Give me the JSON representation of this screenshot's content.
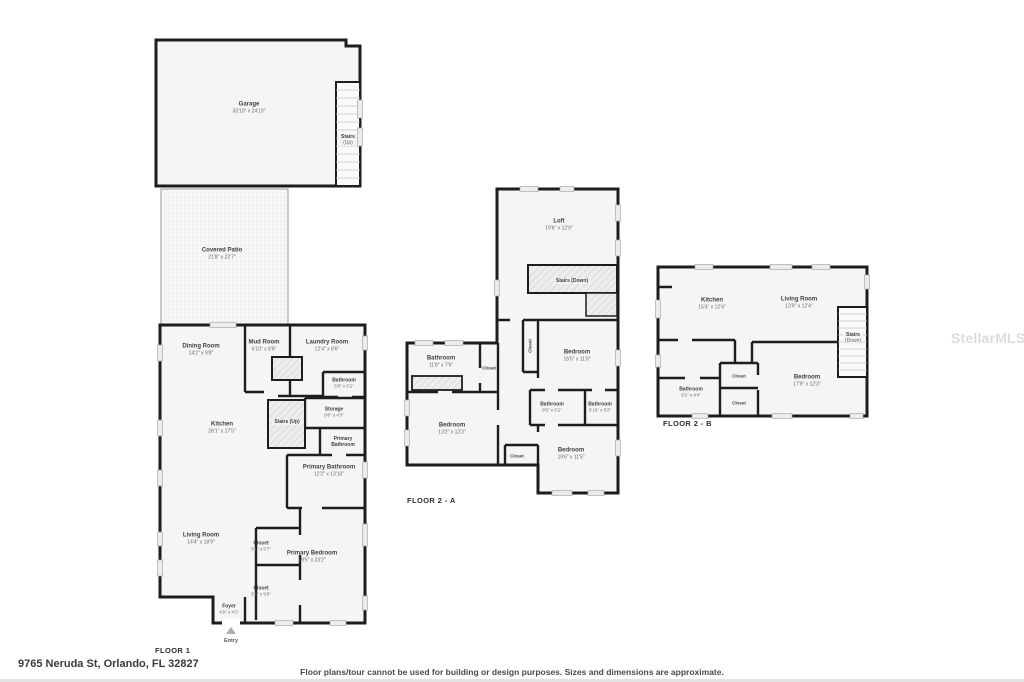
{
  "watermark": "StellarMLS",
  "footer": {
    "address": "9765 Neruda St, Orlando, FL 32827",
    "disclaimer": "Floor plans/tour cannot be used for building or design purposes. Sizes and dimensions are approximate."
  },
  "floor1": {
    "label": "FLOOR 1",
    "entry_label": "Entry",
    "rooms": {
      "garage": {
        "name": "Garage",
        "dims": "33'10\" x 24'10\""
      },
      "garage_stairs": {
        "name": "Stairs",
        "dims": "(Up)"
      },
      "covered_patio": {
        "name": "Covered Patio",
        "dims": "21'8\" x 22'7\""
      },
      "dining_room": {
        "name": "Dining Room",
        "dims": "14'2\" x 9'8\""
      },
      "mud_room": {
        "name": "Mud Room",
        "dims": "6'10\" x 8'6\""
      },
      "laundry_room": {
        "name": "Laundry Room",
        "dims": "12'4\" x 8'6\""
      },
      "bathroom": {
        "name": "Bathroom",
        "dims": "5'8\" x 5'2\""
      },
      "kitchen": {
        "name": "Kitchen",
        "dims": "26'1\" x 17'5\""
      },
      "stairs_up": {
        "name": "Stairs (Up)"
      },
      "storage": {
        "name": "Storage",
        "dims": "9'8\" x 4'3\""
      },
      "primary_bathroom_wc": {
        "name": "Primary Bathroom"
      },
      "primary_bathroom": {
        "name": "Primary Bathroom",
        "dims": "12'2\" x 13'10\""
      },
      "living_room": {
        "name": "Living Room",
        "dims": "14'4\" x 18'9\""
      },
      "closet_1": {
        "name": "Closet",
        "dims": "5'1\" x 5'7\""
      },
      "closet_2": {
        "name": "Closet",
        "dims": "5'1\" x 9'6\""
      },
      "primary_bedroom": {
        "name": "Primary Bedroom",
        "dims": "19'5\" x 23'2\""
      },
      "foyer": {
        "name": "Foyer",
        "dims": "4'9\" x 4'1\""
      }
    }
  },
  "floor2a": {
    "label": "FLOOR 2 - A",
    "rooms": {
      "loft": {
        "name": "Loft",
        "dims": "19'6\" x 12'9\""
      },
      "stairs_down": {
        "name": "Stairs (Down)"
      },
      "closet_hall": {
        "name": "Closet"
      },
      "bedroom_1": {
        "name": "Bedroom",
        "dims": "15'5\" x 11'8\""
      },
      "bathroom_1": {
        "name": "Bathroom",
        "dims": "11'8\" x 7'6\""
      },
      "closet_bath": {
        "name": "Closet"
      },
      "bedroom_2": {
        "name": "Bedroom",
        "dims": "13'2\" x 12'3\""
      },
      "bathroom_2": {
        "name": "Bathroom",
        "dims": "9'5\" x 5'2\""
      },
      "bathroom_3": {
        "name": "Bathroom",
        "dims": "5'10\" x 5'2\""
      },
      "closet_bottom": {
        "name": "Closet"
      },
      "bedroom_3": {
        "name": "Bedroom",
        "dims": "19'6\" x 11'5\""
      }
    }
  },
  "floor2b": {
    "label": "FLOOR 2 - B",
    "rooms": {
      "kitchen": {
        "name": "Kitchen",
        "dims": "15'4\" x 12'4\""
      },
      "living_room": {
        "name": "Living Room",
        "dims": "13'9\" x 12'4\""
      },
      "stairs_down": {
        "name": "Stairs",
        "dims": "(Down)"
      },
      "closet_1": {
        "name": "Closet"
      },
      "closet_2": {
        "name": "Closet"
      },
      "bedroom": {
        "name": "Bedroom",
        "dims": "17'9\" x 12'3\""
      },
      "bathroom": {
        "name": "Bathroom",
        "dims": "9'2\" x 4'4\""
      }
    }
  }
}
